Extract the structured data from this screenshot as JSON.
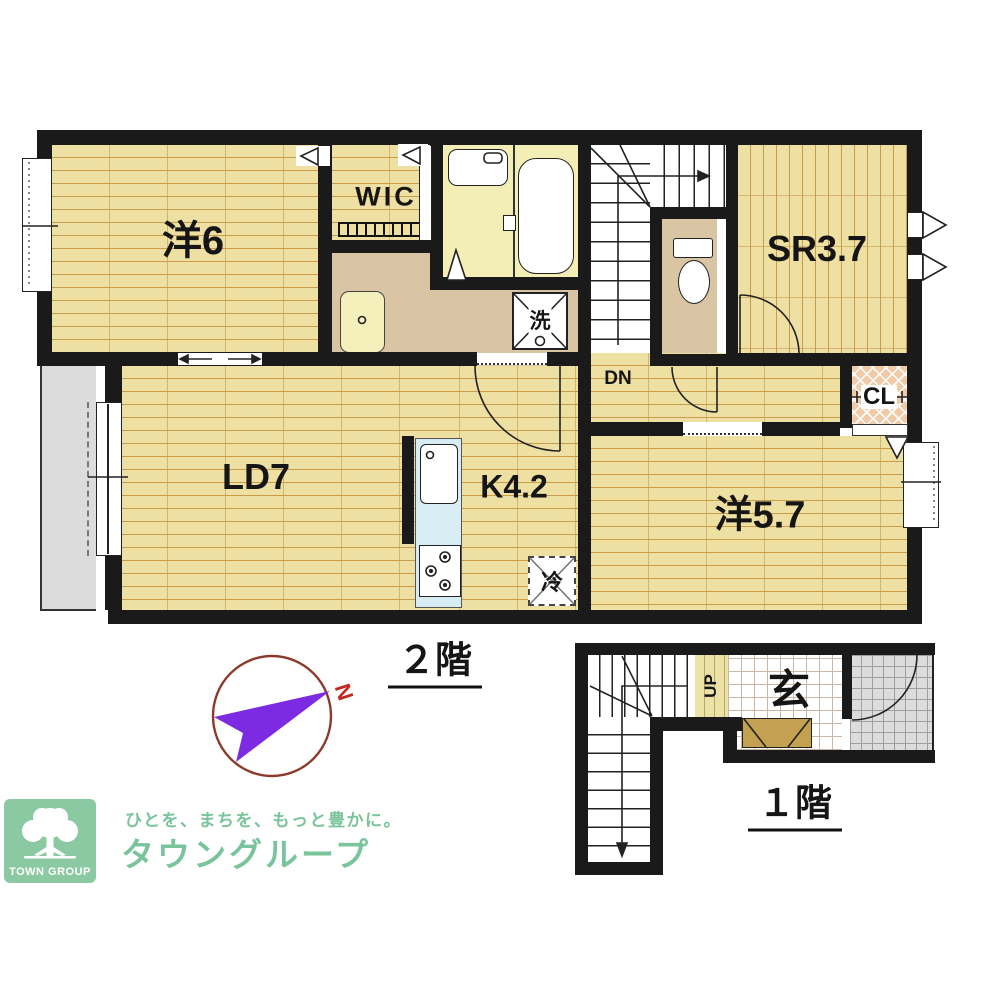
{
  "floor2": {
    "title": "２階",
    "rooms": {
      "western6": "洋6",
      "wic": "WIC",
      "service_room": "SR3.7",
      "living_dining": "LD7",
      "kitchen": "K4.2",
      "western57": "洋5.7",
      "closet": "CL"
    },
    "marks": {
      "down": "DN",
      "fridge": "冷",
      "laundry": "洗"
    }
  },
  "floor1": {
    "title": "１階",
    "rooms": {
      "entrance": "玄"
    },
    "marks": {
      "up": "UP"
    }
  },
  "compass": {
    "north": "N"
  },
  "logo": {
    "badge": "TOWN GROUP",
    "tagline": "ひとを、まちを、もっと豊かに。",
    "company": "タウングループ"
  },
  "palette": {
    "wall": "#1a1a1a",
    "wood": "#eedfa2",
    "woodline": "#c79d49",
    "beige": "#d9c4a3",
    "bathf": "#f2eeb6",
    "pink": "#f1caa7",
    "blue": "#d8edf3",
    "gray": "#dcdcdc",
    "green": "#8bc9a3",
    "greentxt": "#79c49b",
    "purple": "#7d2be2",
    "nred": "#c5281c",
    "brown": "#c3a150",
    "tileline": "#c9b6a4",
    "porchline": "#9e9e9e"
  }
}
